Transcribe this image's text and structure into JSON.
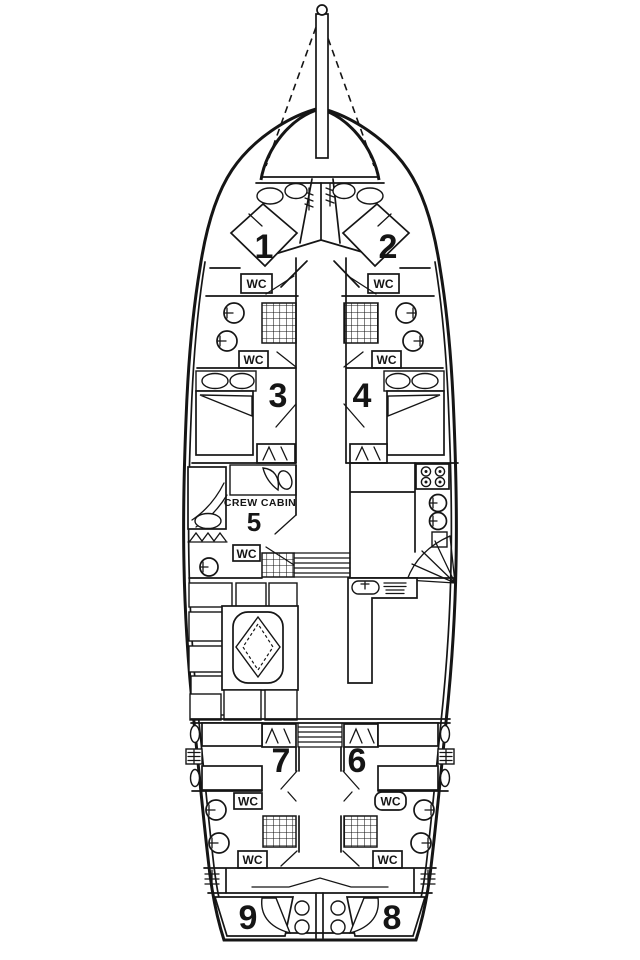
{
  "diagram": {
    "type": "yacht-deck-plan",
    "colors": {
      "line": "#151515",
      "background": "#ffffff"
    },
    "cabins": [
      {
        "number": "1"
      },
      {
        "number": "2"
      },
      {
        "number": "3"
      },
      {
        "number": "4"
      },
      {
        "number": "5"
      },
      {
        "number": "6"
      },
      {
        "number": "7"
      },
      {
        "number": "8"
      },
      {
        "number": "9"
      }
    ],
    "labels": {
      "wc": "WC",
      "crew_cabin": "CREW CABIN"
    }
  }
}
